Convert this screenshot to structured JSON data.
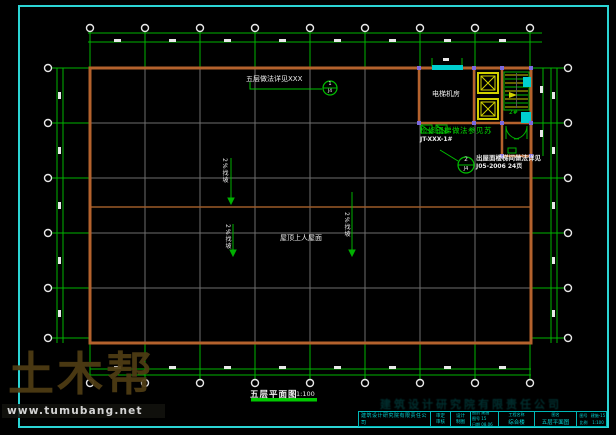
{
  "colors": {
    "frame": "#2bd5d5",
    "dimension_green": "#00b400",
    "grid_gray": "#6e6e6e",
    "wall_orange": "#b4622d",
    "accent_cyan": "#00cfcf",
    "elevator_yellow": "#d2d200",
    "column_marker": "#7d6ae0",
    "text_white": "#ececec"
  },
  "watermark": {
    "brand": "土木帮",
    "url": "www.tumubang.net"
  },
  "plan": {
    "title": "五层平面图",
    "scale": "1:100",
    "labels": {
      "machine_room": "电梯机房",
      "roof": "屋顶上人屋面",
      "stair_no": "2#",
      "slope": "2%找坡",
      "top_note": "五层做法详见XXX",
      "repair_note": "检修钢梯做法参见苏",
      "repair_ref": "JT-XXX-1#",
      "stair_note_line1": "出屋面楼梯间做法详见",
      "stair_note_line2": "J05-2006 24页"
    },
    "callouts": {
      "top_num": "1",
      "top_ref": "J4",
      "mid_num": "2",
      "mid_ref": "J4"
    }
  },
  "titleblock": {
    "ghost": "建筑设计研究院有限责任公司",
    "company": "建筑设计研究院有限责任公司",
    "certs": [
      "审定",
      "审核"
    ],
    "stamps": [
      "设计",
      "制图"
    ],
    "meta": [
      "图别 建施",
      "图号 15",
      "日期 08.06"
    ],
    "project_label": "工程名称",
    "project_value": "综合楼",
    "drawing_label": "图名",
    "drawing_value": "五层平面图",
    "num_label": "图号",
    "num_value": "建施-15",
    "scale_label": "比例",
    "scale_value": "1:100"
  }
}
